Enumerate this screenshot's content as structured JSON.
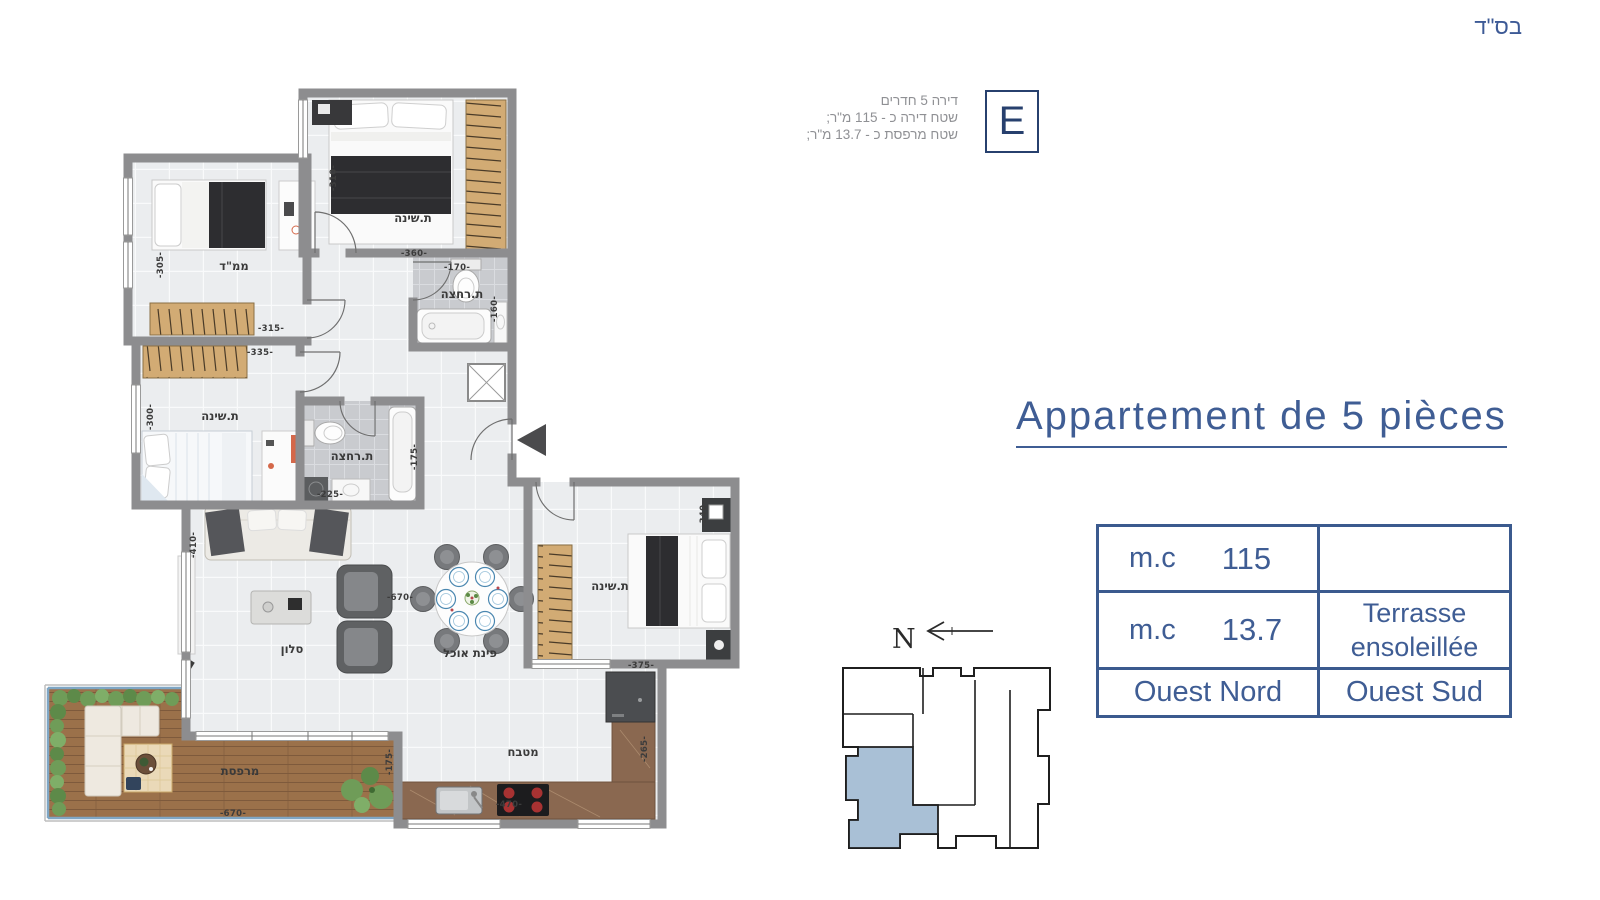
{
  "page": {
    "bsd": "בס\"ד"
  },
  "unit_info": {
    "line1": "דירה 5 חדרים",
    "line2": "שטח דירה כ - 115 מ\"ר;",
    "line3": "שטח מרפסת כ - 13.7 מ\"ר;",
    "unit_letter": "E"
  },
  "title": {
    "text": "Appartement de 5 pièces"
  },
  "spec_table": {
    "row1": {
      "unit": "m.c",
      "value": "115",
      "note": ""
    },
    "row2": {
      "unit": "m.c",
      "value": "13.7",
      "note": "Terrasse ensoleillée"
    },
    "row3": {
      "left": "Ouest Nord",
      "right": "Ouest Sud"
    }
  },
  "compass": {
    "north_label": "N"
  },
  "plan": {
    "rooms": {
      "bedroom_top": "ת.שינה",
      "mamad": "ממ\"ד",
      "bath_top": "ת.רחצה",
      "bedroom_left": "ת.שינה",
      "bath_mid": "ת.רחצה",
      "salon": "סלון",
      "dining": "פינת אוכל",
      "kitchen": "מטבח",
      "bedroom_master": "ת.שינה",
      "terrace": "מרפסת"
    },
    "dims": {
      "bedroom_top_w": "-360-",
      "bedroom_top_h": "-310-",
      "mamad_w": "-315-",
      "mamad_h": "-305-",
      "bath_top_w": "-170-",
      "bath_top_h": "-160-",
      "bedroom_left_w": "-335-",
      "bedroom_left_h": "-300-",
      "bath_mid_w": "-225-",
      "bath_mid_h": "-175-",
      "salon_w": "-670-",
      "salon_h": "-410-",
      "bedroom_master_w": "-375-",
      "bedroom_master_h": "-340-",
      "kitchen_w": "-470-",
      "kitchen_h": "-265-",
      "terrace_w": "-670-",
      "terrace_h": "-175-"
    }
  },
  "colors": {
    "accent_blue": "#3f5d94",
    "navy": "#27406e",
    "wall_gray": "#8d8d8f",
    "keyplan_highlight": "#a9c0d6"
  }
}
